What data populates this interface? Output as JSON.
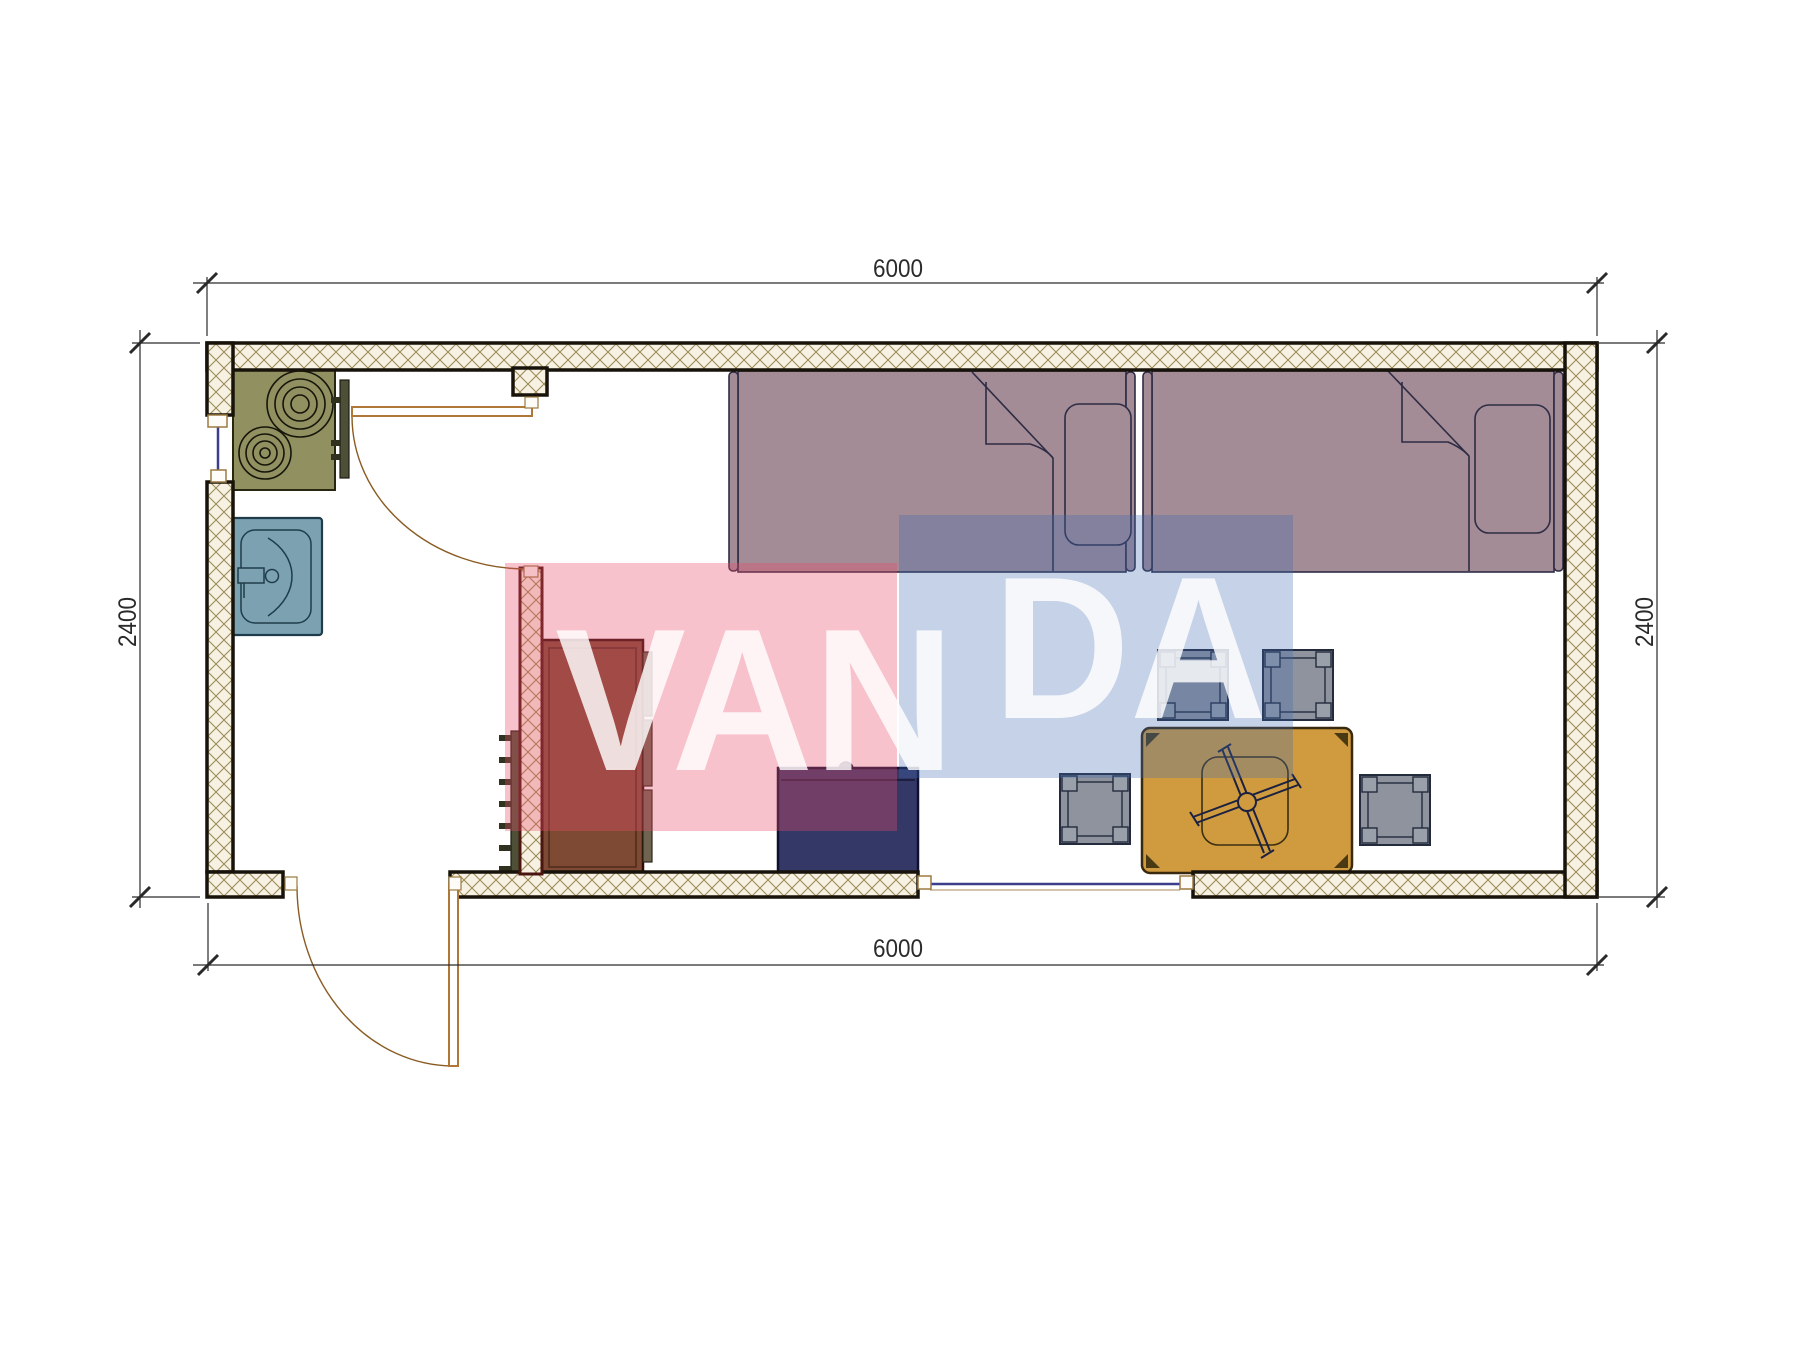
{
  "drawing": {
    "type": "floor-plan",
    "units": "mm",
    "plan_width_mm": "6000",
    "plan_depth_mm": "2400"
  },
  "dimensions": {
    "top": "6000",
    "bottom": "6000",
    "left": "2400",
    "right": "2400"
  },
  "watermark": {
    "text": "VANDA",
    "part1": "VAN",
    "part2": "DA"
  },
  "elements": [
    "exterior-walls",
    "interior-partition-wall",
    "entrance-door",
    "bathroom-door",
    "window-left",
    "window-bottom",
    "cooktop-2-burner",
    "kitchen-sink",
    "radiator",
    "wardrobe",
    "nightstand",
    "single-bed-left",
    "single-bed-right",
    "pillow",
    "dining-table",
    "ceiling-fan-symbol",
    "stool",
    "stool",
    "stool",
    "stool"
  ],
  "colors": {
    "wall_hatch_bg": "#f6f1e2",
    "wall_hatch_line": "#9d8d58",
    "wall_border": "#17120a",
    "interior_wall_border": "#4a150e",
    "bed": "#a38c96",
    "bed_outline": "#2e2c45",
    "stove": "#909060",
    "sink": "#7ca2b2",
    "wardrobe": "#7e4a34",
    "wardrobe_panel": "#6f6450",
    "nightstand": "#343867",
    "table": "#d09b3f",
    "stool": "#8e939d",
    "stool_corner": "#9aa0aa",
    "radiator": "#4d4f37",
    "door": "#b07838",
    "door_arc": "#8a5c24",
    "window": "#3a3e8c",
    "dimension": "#2a2a2a",
    "watermark_pink": "rgba(232,76,106,0.34)",
    "watermark_blue": "rgba(62,105,178,0.30)",
    "watermark_text": "rgba(255,255,255,0.82)"
  }
}
